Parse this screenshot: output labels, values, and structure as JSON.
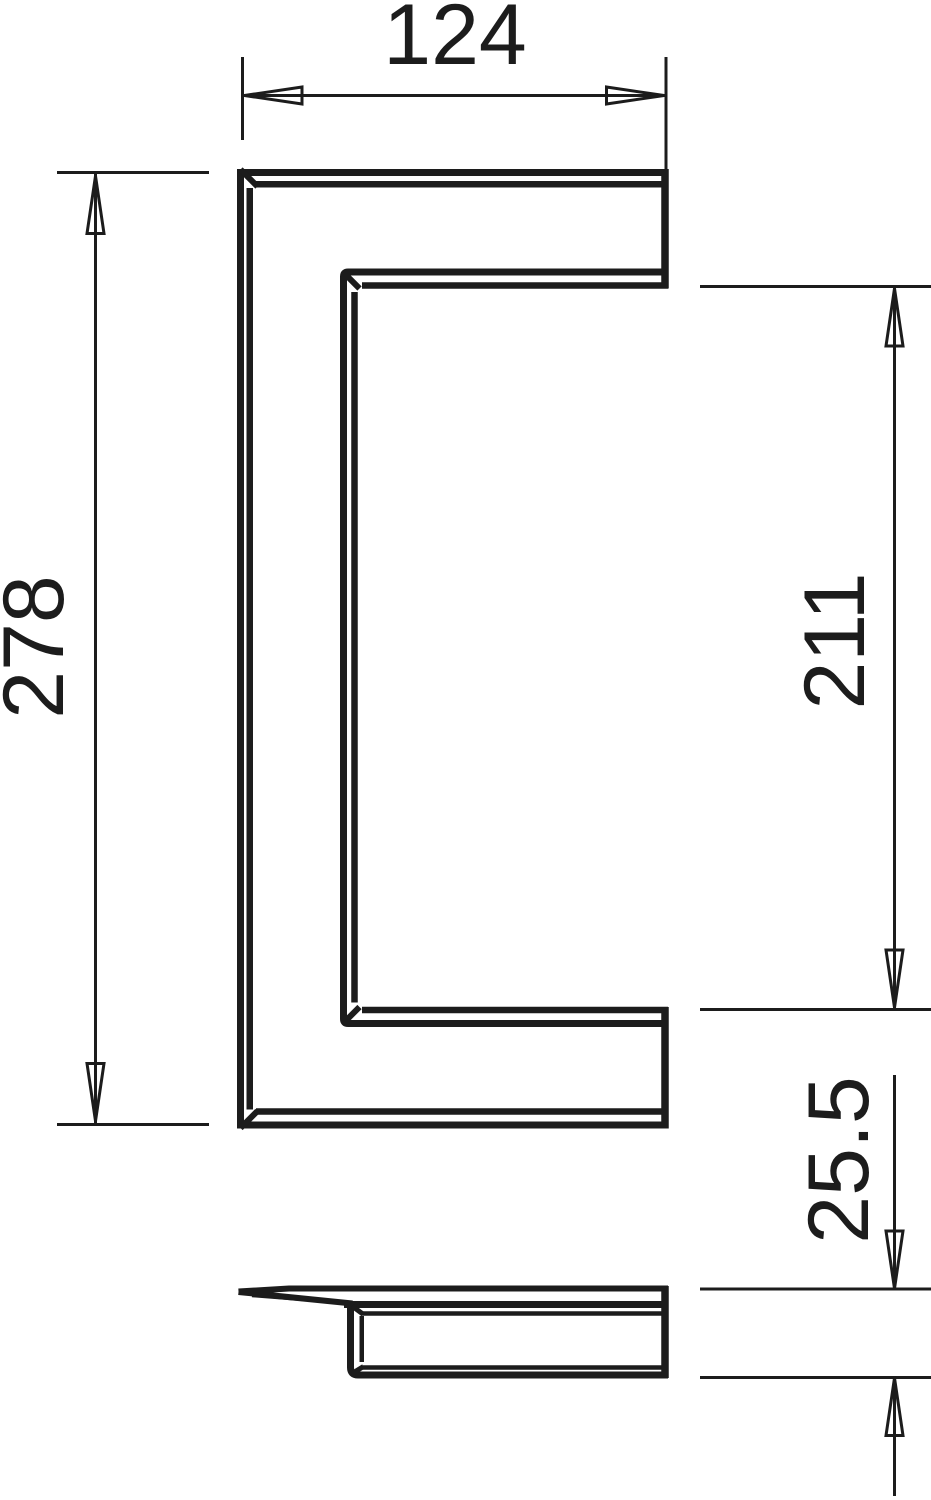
{
  "drawing": {
    "kind": "technical-dimension-drawing",
    "colors": {
      "line": "#1c1c1c",
      "background": "#ffffff"
    },
    "dimensions": {
      "outer_width": {
        "value": "124"
      },
      "outer_height": {
        "value": "278"
      },
      "inner_height": {
        "value": "211"
      },
      "depth": {
        "value": "25.5"
      }
    }
  }
}
